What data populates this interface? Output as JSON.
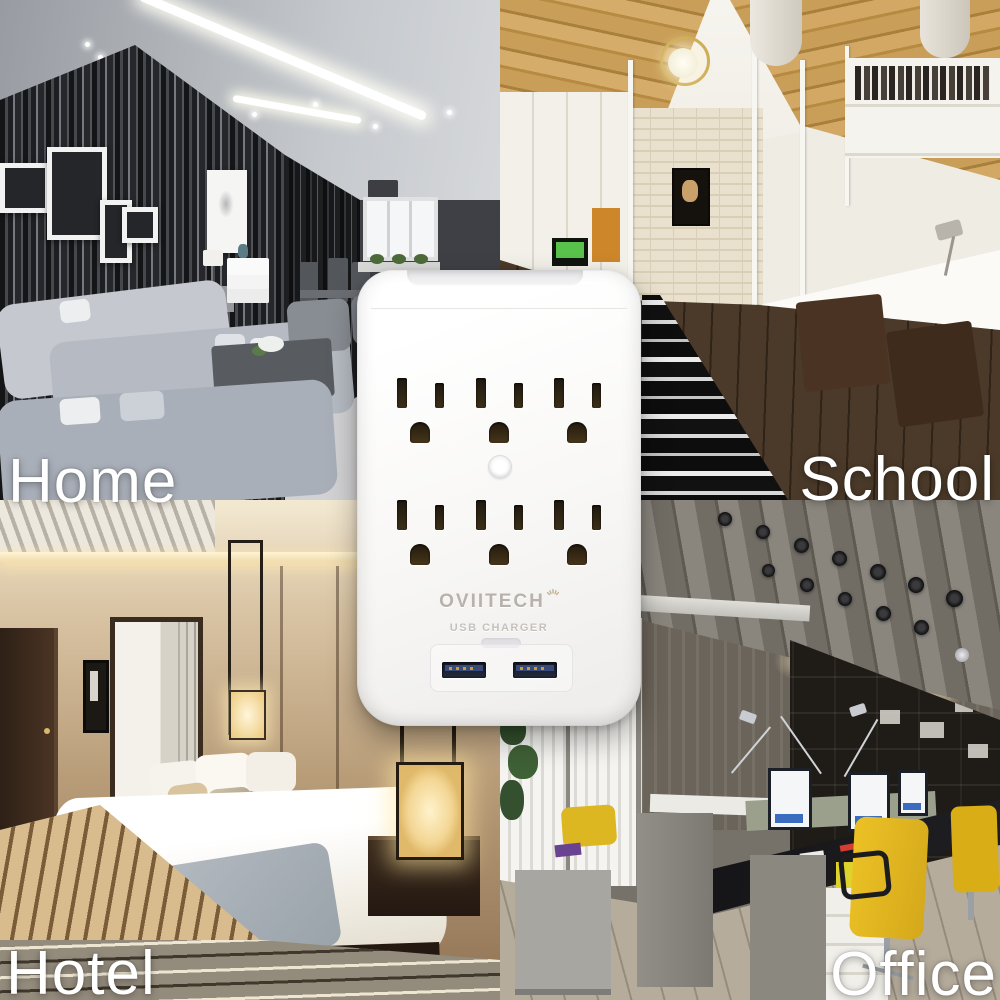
{
  "scene": {
    "type": "product lifestyle collage",
    "quadrants": [
      {
        "id": "home",
        "label": "Home",
        "setting": "modern living room"
      },
      {
        "id": "school",
        "label": "School",
        "setting": "dorm study room"
      },
      {
        "id": "hotel",
        "label": "Hotel",
        "setting": "hotel bedroom"
      },
      {
        "id": "office",
        "label": "Office",
        "setting": "open-plan office"
      }
    ],
    "label_text_color": "#ffffff"
  },
  "product": {
    "brand": "OVIITECH",
    "usb_section_label": "USB CHARGER",
    "ac_outlets_total": 6,
    "ac_outlet_rows": 2,
    "ac_outlets_per_row": 3,
    "usb_ports_total": 2,
    "has_center_led": true,
    "body_color": "#f7f6f3",
    "usb_port_color": "#1c2536",
    "logo_color": "#b9b2ac"
  }
}
